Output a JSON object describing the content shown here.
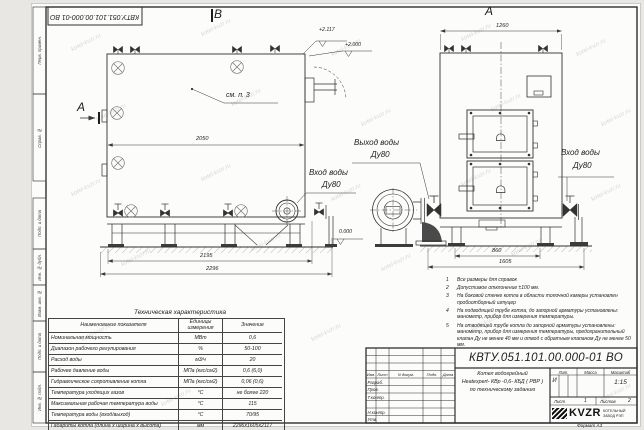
{
  "page": {
    "stamp_top": "КВТУ.051.101.00.000-01 ВО",
    "format_label": "Формат  А3",
    "watermark": "kotel-kvzr.ru"
  },
  "margin_labels": {
    "perv_primen": "Перв. примен.",
    "sprav_no": "Справ. №",
    "podp_data_1": "Подп. и дата",
    "inv_dubl": "Инв. № дубл.",
    "vzam_inv": "Взам. инв. №",
    "podp_data_2": "Подп. и дата",
    "inv_podl": "Инв. № подл."
  },
  "views": {
    "side": {
      "view_label": "В",
      "section_label": "А",
      "see_note": "см. п. 3",
      "dim_width": "2050",
      "dim_frame": "2195",
      "dim_overall": "2296",
      "elev_top": "+2.117",
      "elev_mid": "+2.000",
      "elev_zero": "0.000",
      "outlet_line1": "Выход воды",
      "outlet_line2": "Ду80",
      "inlet_line1": "Вход воды",
      "inlet_line2": "Ду80"
    },
    "front": {
      "view_label": "А",
      "dim_width": "1260",
      "dim_frame": "860",
      "dim_overall": "1605",
      "inlet_line1": "Вход воды",
      "inlet_line2": "Ду80"
    }
  },
  "notes": {
    "items": [
      {
        "num": "1",
        "text": "Все размеры для справок"
      },
      {
        "num": "2",
        "text": "Допустимое отклонение ±100 мм."
      },
      {
        "num": "3",
        "text": "На боковой стенке котла в области топочной камеры установлен пробоотборный штуцер"
      },
      {
        "num": "4",
        "text": "На  подводящей трубе котла, до запорной арматуры установлены:  манометр, прибор для измерения температуры."
      },
      {
        "num": "5",
        "text": "На отводящей трубе котла до запорной арматуры установлены:  манометр, прибор для измерения температуры, предохранительный клапан Ду не менее 40 мм и отвод с обратным клапаном Ду не менее 50 мм."
      }
    ]
  },
  "tech_table": {
    "title": "Техническая характеристика",
    "headers": [
      "Наименование показателя",
      "Единицы измерения",
      "Значение"
    ],
    "rows": [
      [
        "Номинальная мощность",
        "МВт",
        "0,6"
      ],
      [
        "Диапазон рабочего регулирования",
        "%",
        "50-100"
      ],
      [
        "Расход воды",
        "м3/ч",
        "20"
      ],
      [
        "Рабочее давление воды",
        "МПа (кгс/см2)",
        "0,6 (6,0)"
      ],
      [
        "Гидравлическое сопротивление котла",
        "МПа (кгс/см2)",
        "0,06 (0,6)"
      ],
      [
        "Температура уходящих газов",
        "°С",
        "не более 220"
      ],
      [
        "Максимальная рабочая температура воды",
        "°С",
        "115"
      ],
      [
        "Температура воды (вход/выход)",
        "°С",
        "70/95"
      ],
      [
        "Габариты котла (длина х ширина х высота)",
        "мм",
        "2296х1605х2117"
      ]
    ]
  },
  "title_block": {
    "doc_number": "КВТУ.051.101.00.000-01 ВО",
    "description": {
      "line1": "Котел водогрейный",
      "line2": "Heatexpert- КВр -0,6- КБД ( РВР )",
      "line3": "по техническому заданию"
    },
    "header_cells": [
      "Изм.",
      "Лист",
      "N докум.",
      "Подп.",
      "Дата"
    ],
    "rows": [
      "Разраб.",
      "Пров.",
      "Т.контр.",
      "Н.контр.",
      "Утв."
    ],
    "lit_label": "Лит.",
    "lit_value": "И",
    "mass_label": "Масса",
    "scale_label": "Масштаб",
    "scale_value": "1:15",
    "sheet_label": "Лист",
    "sheet_value": "1",
    "sheets_label": "Листов",
    "sheets_value": "2",
    "logo_text": "KVZR",
    "company_line1": "КОТЕЛЬНЫЙ",
    "company_line2": "ЗАВОД РЭП"
  }
}
